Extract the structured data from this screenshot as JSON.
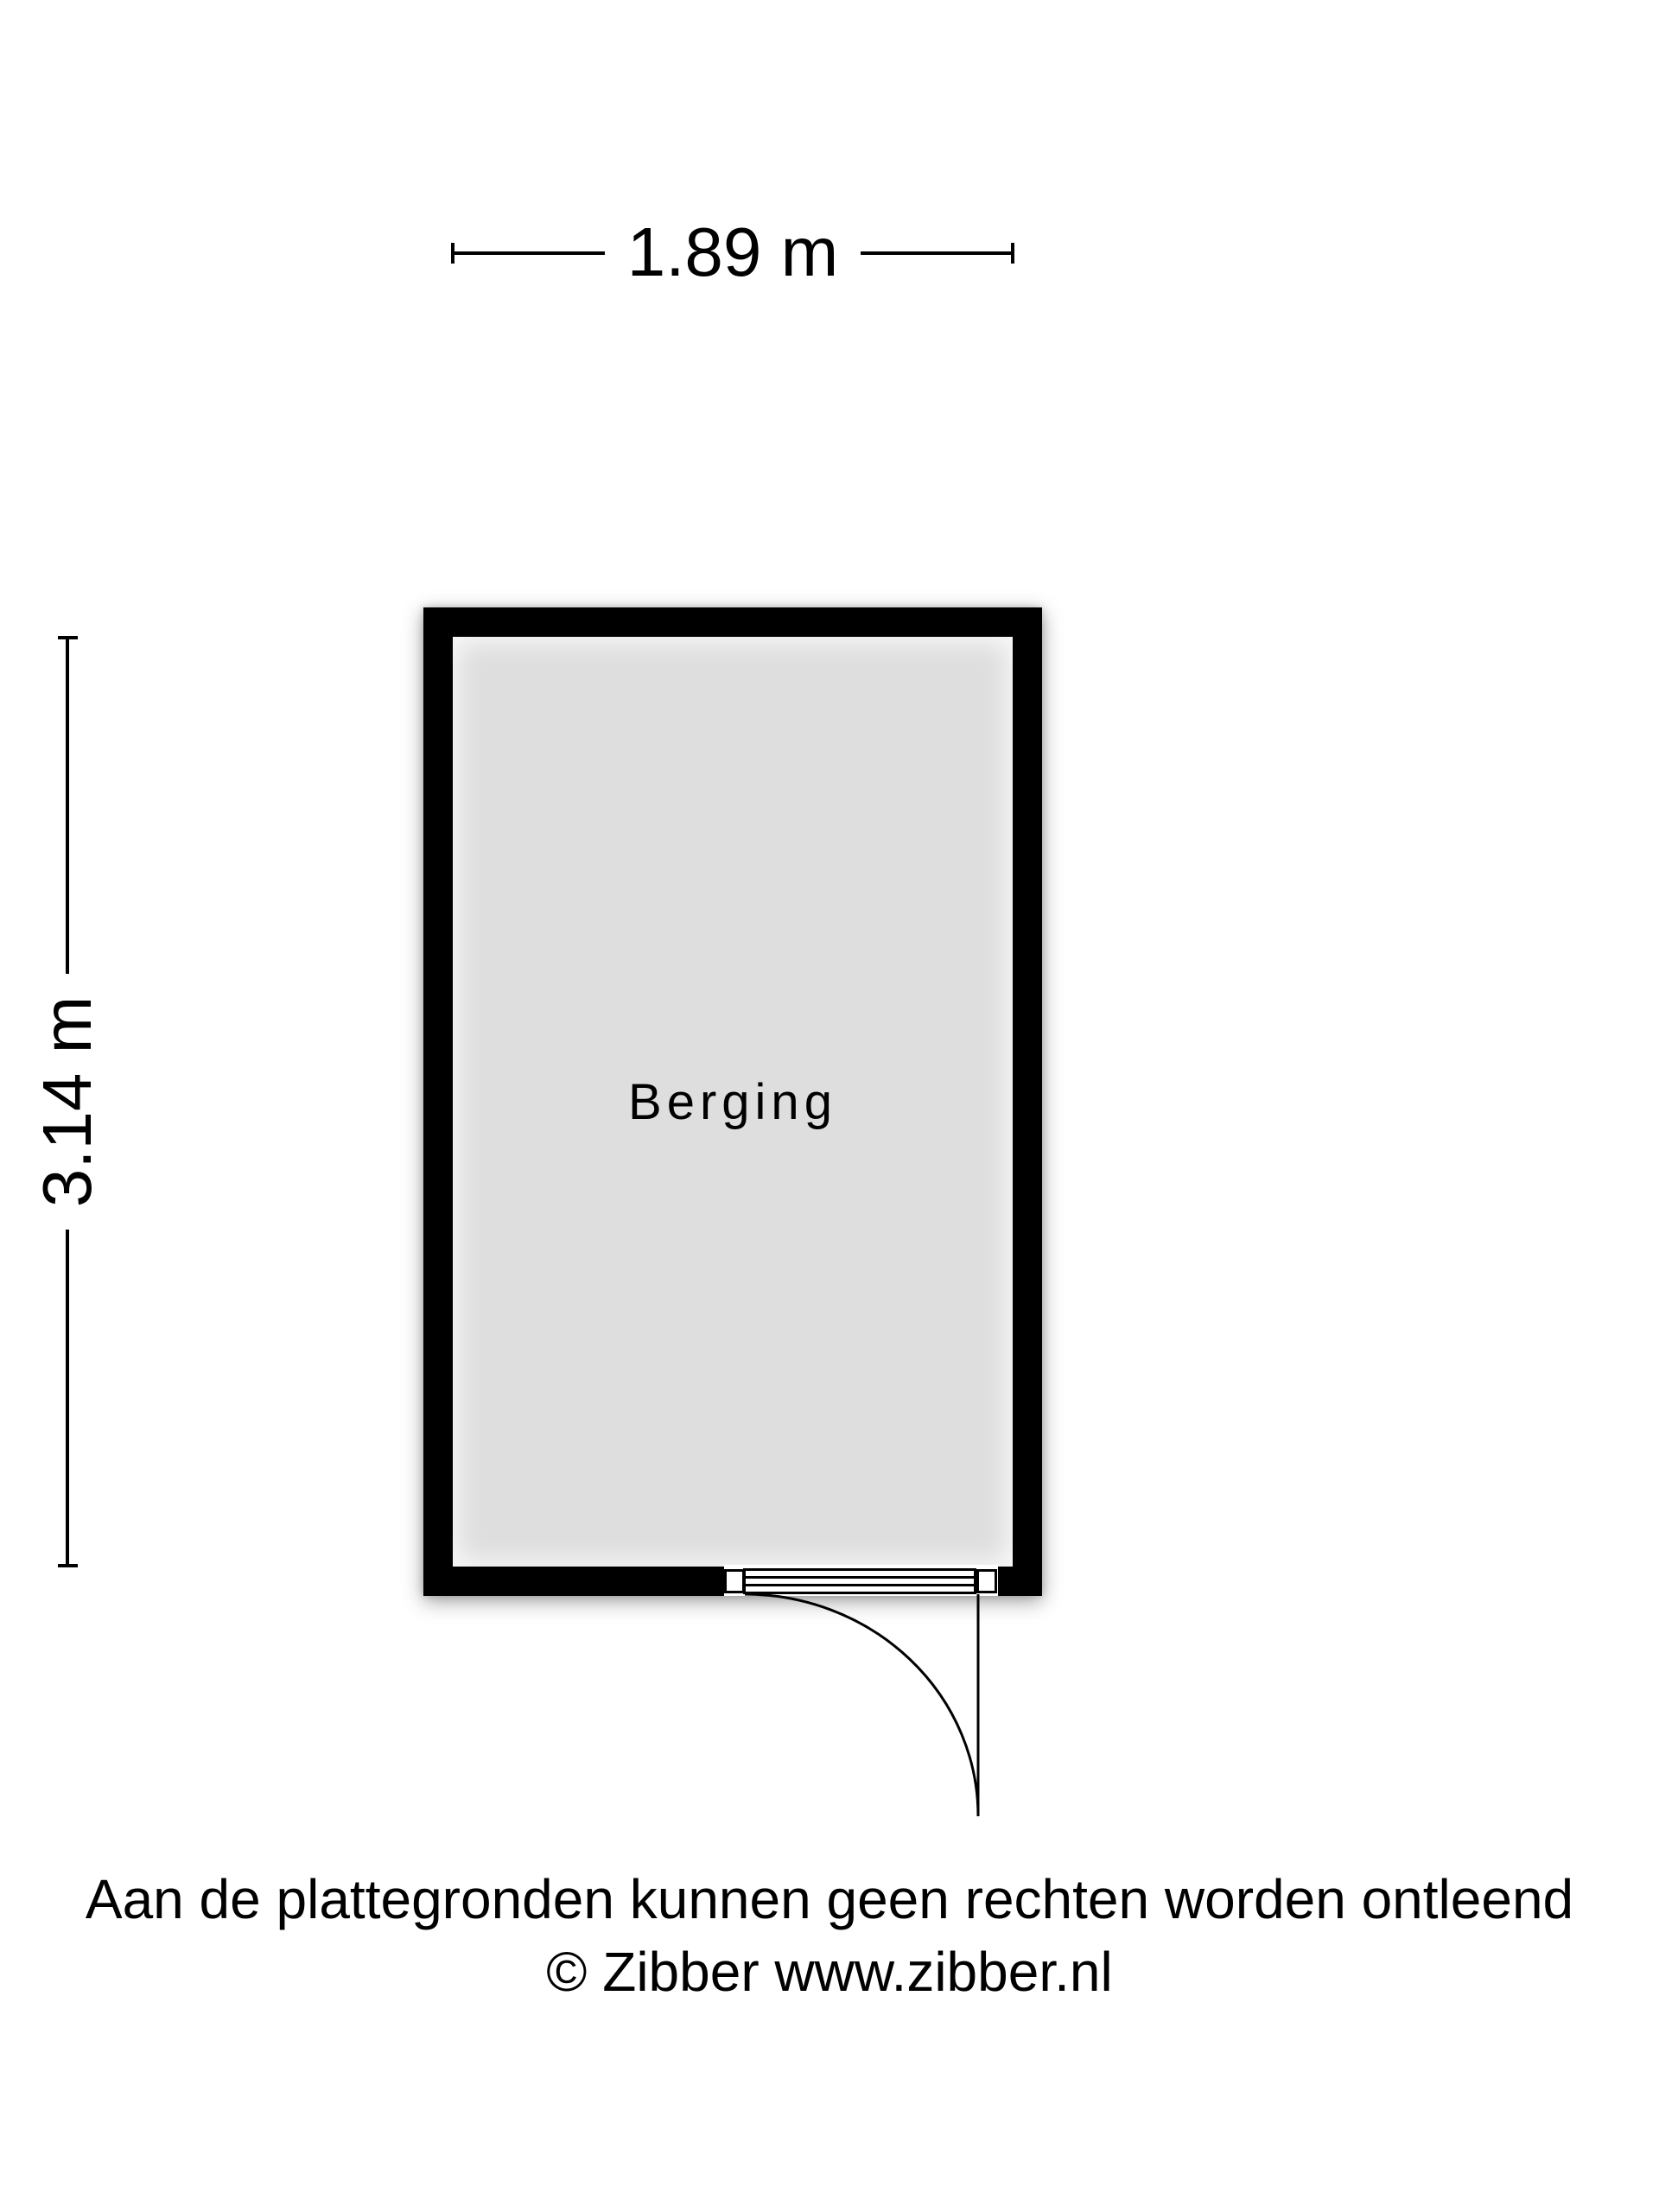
{
  "floorplan": {
    "room": {
      "label": "Berging"
    },
    "dimensions": {
      "width_label": "1.89 m",
      "height_label": "3.14 m"
    },
    "door": {
      "type": "hinged-door-swing",
      "position": "bottom-right"
    }
  },
  "footer": {
    "disclaimer": "Aan de plattegronden kunnen geen rechten worden ontleend",
    "copyright": "© Zibber www.zibber.nl"
  },
  "colors": {
    "wall": "#000000",
    "room_fill": "#dedede",
    "line": "#000000",
    "background": "#ffffff"
  }
}
